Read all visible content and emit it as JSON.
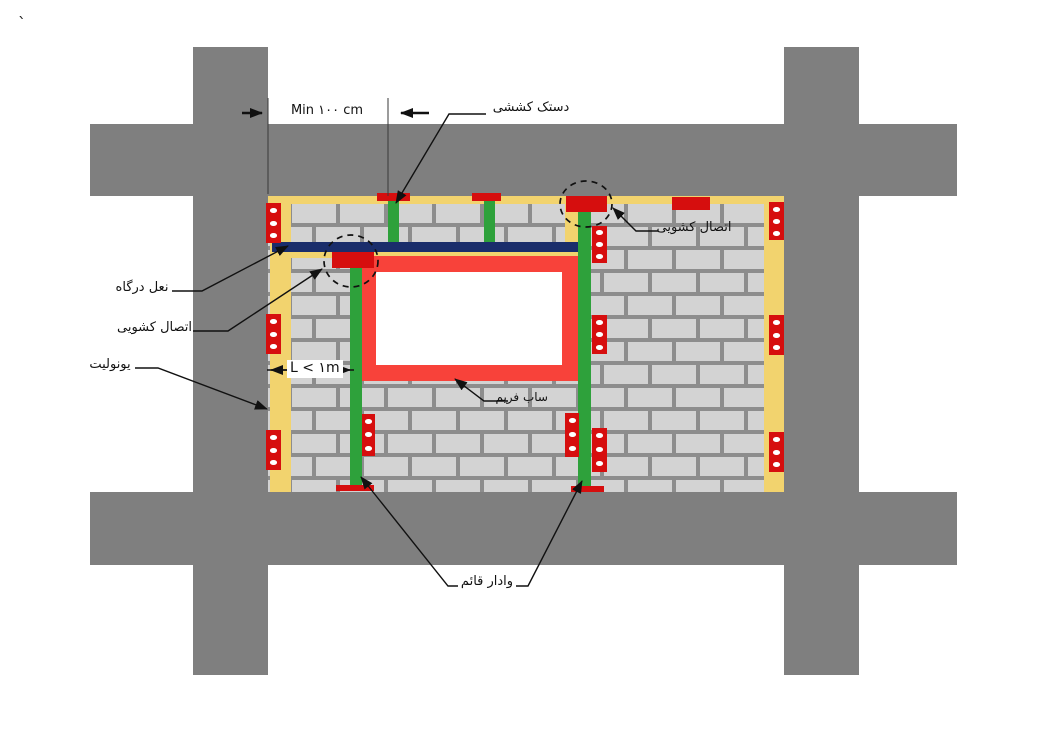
{
  "stray_mark": "`",
  "dimensions": {
    "top_offset": "Min ۱۰۰ cm",
    "window_offset": "L < ۱m"
  },
  "labels": {
    "tension_strut": "دستک کششی",
    "sliding_connection": "اتصال کشویی",
    "lintel": "نعل درگاه",
    "styrofoam": "یونولیت",
    "sub_frame": "ساب فریم",
    "vertical_post": "وادار قائم"
  },
  "colors": {
    "structure_gray": "#7f7f7f",
    "mortar_gray": "#8d8d8d",
    "block_gray": "#d3d3d3",
    "styrofoam_yellow": "#f2d36e",
    "post_green": "#2ea13b",
    "connection_red": "#d60e0e",
    "frame_red": "#f8423a",
    "lintel_navy": "#1a2d6b",
    "line_black": "#111111"
  }
}
